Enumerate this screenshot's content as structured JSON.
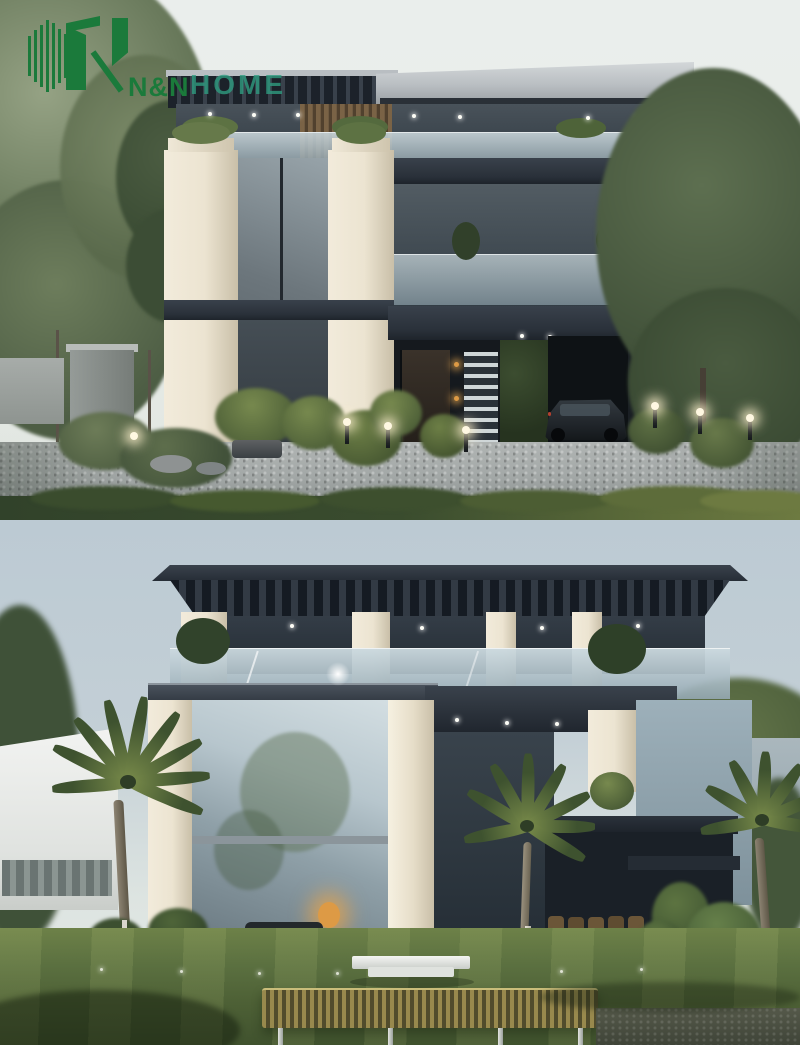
{
  "logo": {
    "brand_bold": "N&N",
    "brand_light": "HOME",
    "monogram": "N",
    "colors": {
      "brand_green": "#1b7a3b",
      "brand_teal": "#2f9c80"
    }
  },
  "palette": {
    "sky_warm": "#e9ede9",
    "sky_cool": "#c3cfd6",
    "roof_dark": "#2a313a",
    "stone_cream": "#ece4d1",
    "glass_light": "#b9c7cd",
    "glass_dark": "#333d45",
    "foliage_dark": "#44563a",
    "foliage_mid": "#5d7243",
    "foliage_light": "#7f9351",
    "lawn_green": "#5b7040",
    "driveway_grey": "#a3a8a7",
    "hedge_green": "#3a4c2e",
    "bench_gold": "#98894d",
    "wood_slat": "#6e5a41",
    "warm_light": "#dd9a45"
  }
}
